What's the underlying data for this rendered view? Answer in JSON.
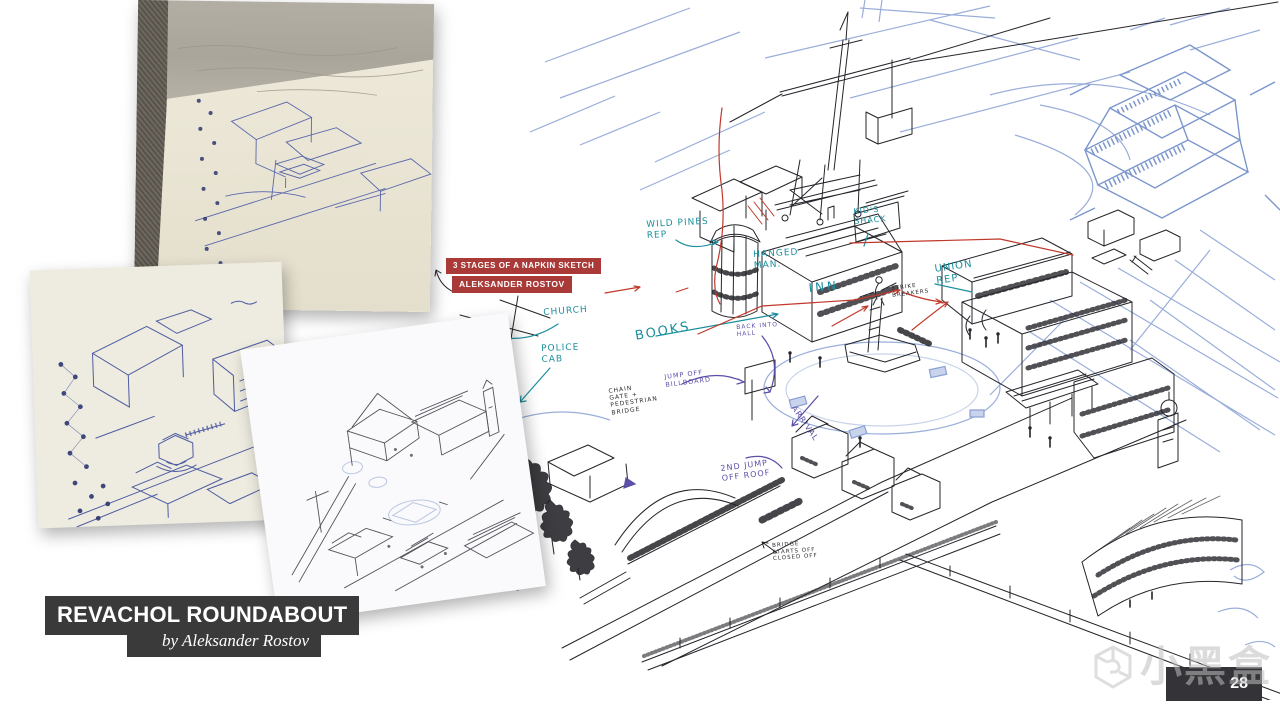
{
  "page": {
    "number": "28",
    "watermark_text": "小黑盒"
  },
  "title_block": {
    "title": "REVACHOL ROUNDABOUT",
    "byline": "by Aleksander Rostov"
  },
  "caption": {
    "line1": "3 STAGES OF A NAPKIN SKETCH",
    "line2": "ALEKSANDER ROSTOV"
  },
  "colors": {
    "caption_bg": "#a93a38",
    "title_bg": "#3a3a3a",
    "teal": "#1a8f9d",
    "purple": "#5b4fa8",
    "red": "#c0392b",
    "ink": "#24242a",
    "pencil_blue": "#8fa5d6",
    "pen_blue": "#46549e"
  },
  "main_drawing": {
    "annotations": [
      {
        "id": "wild-pines-rep",
        "text": "WILD PINES\nREP",
        "color": "teal",
        "x": 646,
        "y": 220,
        "size": 9,
        "rotate": -3
      },
      {
        "id": "kids-shack",
        "text": "KID'S\nSHACK",
        "color": "teal",
        "x": 853,
        "y": 207,
        "size": 8,
        "rotate": -5
      },
      {
        "id": "hanged-man",
        "text": "HANGED\nMAN.",
        "color": "teal",
        "x": 753,
        "y": 250,
        "size": 9,
        "rotate": -3
      },
      {
        "id": "inn",
        "text": "INN",
        "color": "teal",
        "x": 808,
        "y": 281,
        "size": 12,
        "rotate": -5,
        "ls": 3
      },
      {
        "id": "church",
        "text": "CHURCH",
        "color": "teal",
        "x": 543,
        "y": 308,
        "size": 9,
        "rotate": -4
      },
      {
        "id": "police-cab",
        "text": "POLICE\nCAB",
        "color": "teal",
        "x": 541,
        "y": 344,
        "size": 9,
        "rotate": -2
      },
      {
        "id": "books",
        "text": "BOOKS",
        "color": "teal",
        "x": 634,
        "y": 329,
        "size": 13,
        "rotate": -10,
        "ls": 2
      },
      {
        "id": "union-rep",
        "text": "UNION\n   REP",
        "color": "teal",
        "x": 934,
        "y": 264,
        "size": 10,
        "rotate": -8
      },
      {
        "id": "strike-breakers",
        "text": "STRIKE\nBREAKERS",
        "color": "ink",
        "x": 891,
        "y": 286,
        "size": 5.5,
        "rotate": -7
      },
      {
        "id": "back-into-hall",
        "text": "BACK INTO\nHALL",
        "color": "purple",
        "x": 736,
        "y": 324,
        "size": 6,
        "rotate": -4
      },
      {
        "id": "jump-off-billboard",
        "text": "JUMP OFF\nBILLBOARD",
        "color": "purple",
        "x": 664,
        "y": 374,
        "size": 6.5,
        "rotate": -7
      },
      {
        "id": "chain-gate-pedestrian-bridge",
        "text": "CHAIN\nGATE +\nPEDESTRIAN\nBRIDGE",
        "color": "ink",
        "x": 608,
        "y": 388,
        "size": 6,
        "rotate": -8
      },
      {
        "id": "arrival",
        "text": "ARRIVAL",
        "color": "purple",
        "x": 797,
        "y": 404,
        "size": 8,
        "rotate": 55
      },
      {
        "id": "2nd-jump-off-roof",
        "text": "2ND JUMP\nOFF ROOF",
        "color": "purple",
        "x": 720,
        "y": 464,
        "size": 8,
        "rotate": -7
      },
      {
        "id": "bridge-starts-off-closed-off",
        "text": "BRIDGE\nSTARTS OFF\nCLOSED OFF",
        "color": "ink",
        "x": 772,
        "y": 543,
        "size": 5.5,
        "rotate": -4
      }
    ]
  }
}
